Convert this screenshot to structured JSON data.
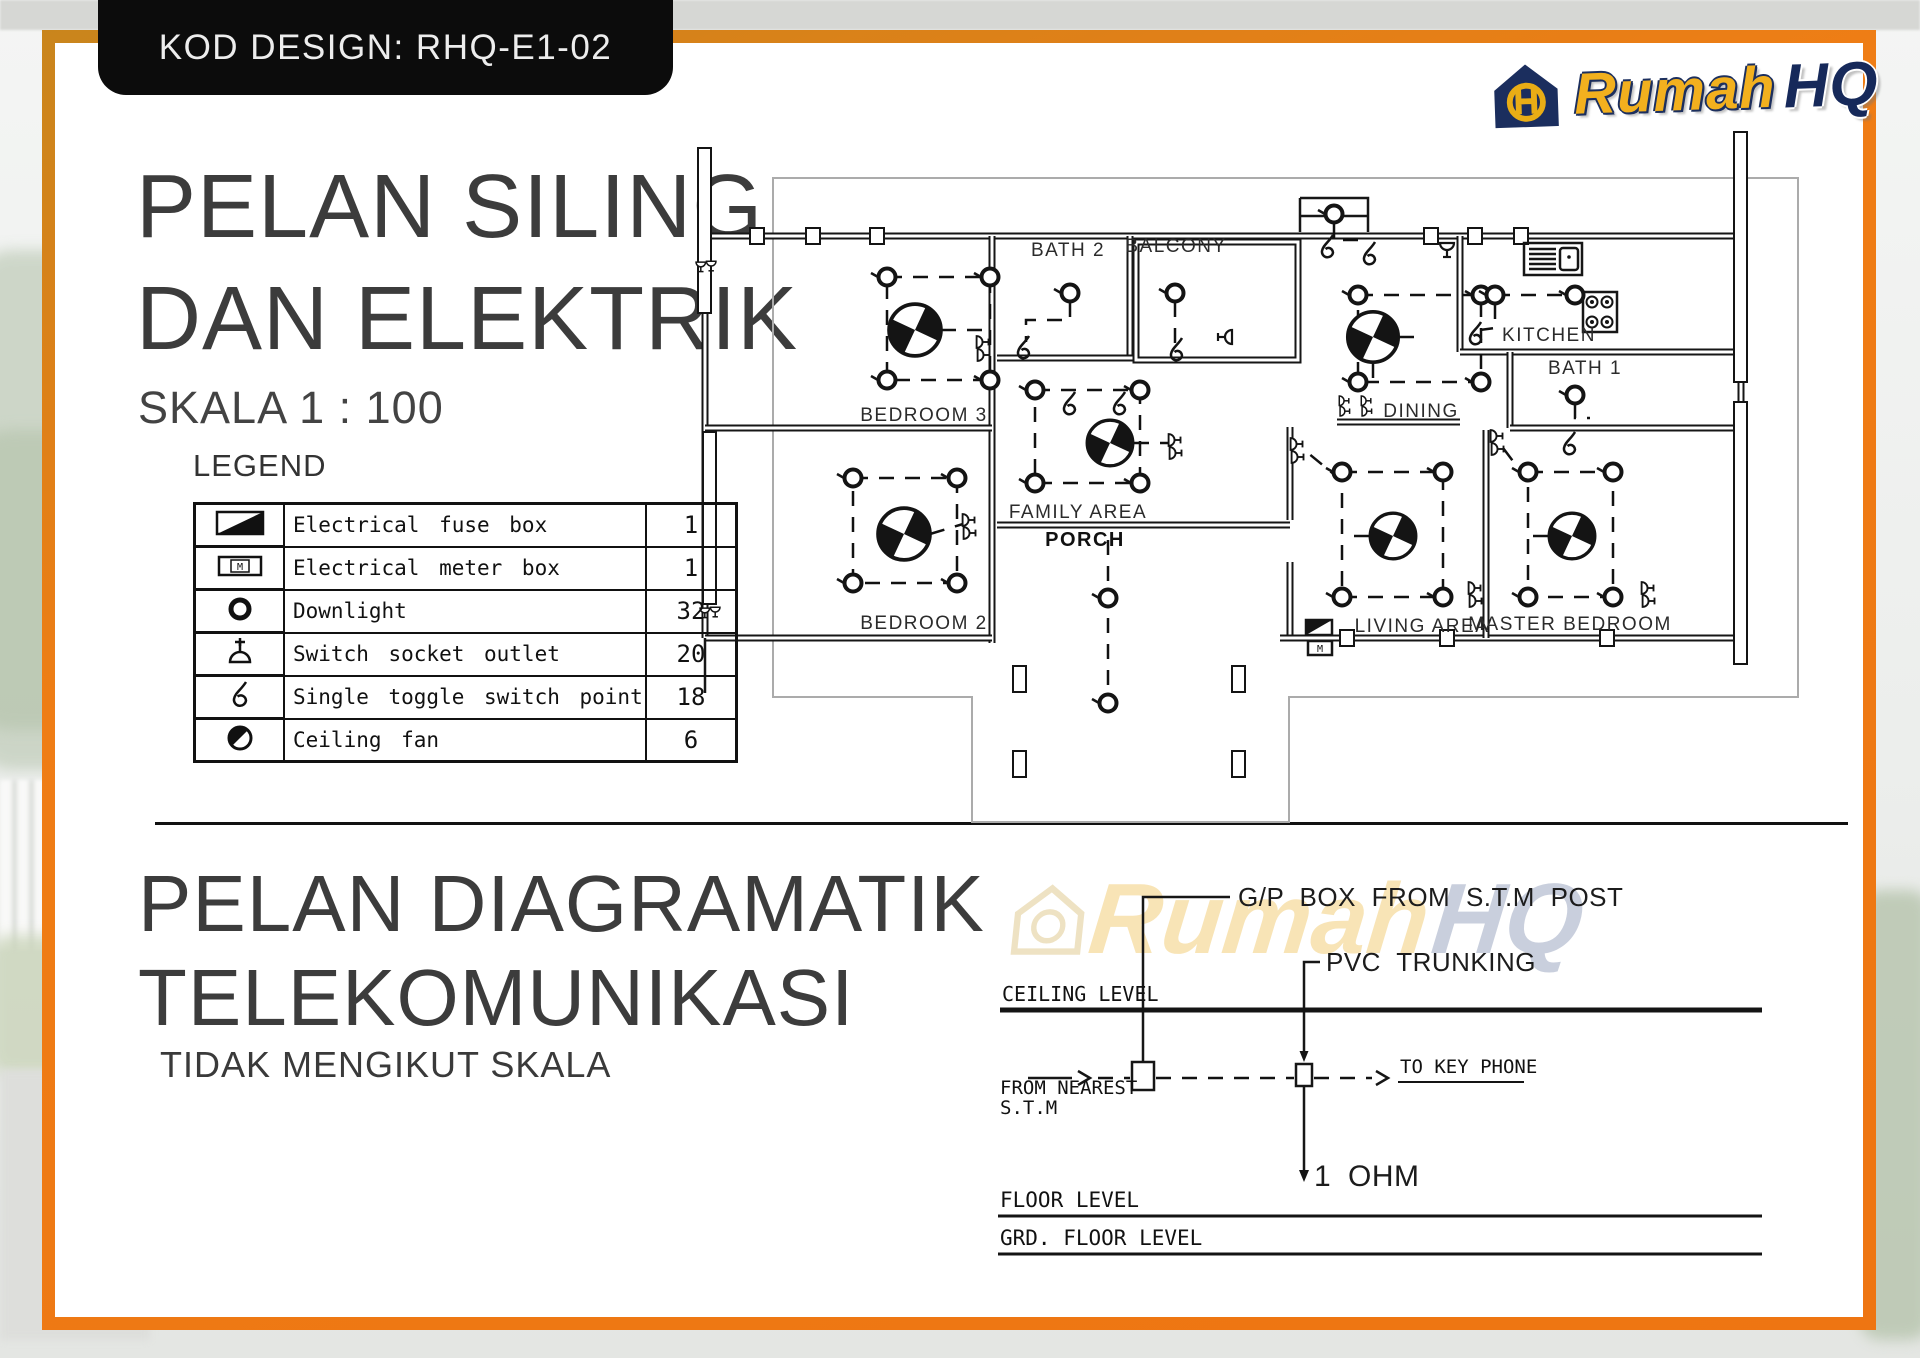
{
  "badge": {
    "label": "KOD DESIGN: RHQ-E1-02"
  },
  "logo": {
    "word_1": "Rumah",
    "word_2": "HQ",
    "icon": "house-monogram-icon",
    "colors": {
      "brand_yellow": "#f2b01e",
      "brand_navy": "#16295a",
      "frame_orange": "#ee7512"
    }
  },
  "section_top": {
    "title_line1": "PELAN SILING",
    "title_line2": "DAN ELEKTRIK",
    "scale": "SKALA 1 : 100",
    "legend": {
      "heading": "LEGEND",
      "rows": [
        {
          "symbol": "fuse-box-symbol",
          "label": "Electrical fuse box",
          "count": "1"
        },
        {
          "symbol": "meter-box-symbol",
          "label": "Electrical meter box",
          "count": "1"
        },
        {
          "symbol": "downlight-symbol",
          "label": "Downlight",
          "count": "32"
        },
        {
          "symbol": "socket-outlet-symbol",
          "label": "Switch socket outlet",
          "count": "20"
        },
        {
          "symbol": "toggle-switch-symbol",
          "label": "Single toggle switch point",
          "count": "18"
        },
        {
          "symbol": "ceiling-fan-symbol",
          "label": "Ceiling fan",
          "count": "6"
        }
      ]
    }
  },
  "floor_plan": {
    "meter_label": "M",
    "rooms": [
      "BATH 2",
      "BALCONY",
      "KITCHEN",
      "BATH 1",
      "BEDROOM 3",
      "DINING",
      "FAMILY AREA",
      "PORCH",
      "BEDROOM 2",
      "LIVING AREA",
      "MASTER BEDROOM"
    ]
  },
  "section_bottom": {
    "title_line1": "PELAN DIAGRAMATIK",
    "title_line2": "TELEKOMUNIKASI",
    "subtitle": "TIDAK MENGIKUT SKALA",
    "diagram": {
      "gp_box": "G/P BOX FROM S.T.M POST",
      "pvc": "PVC TRUNKING",
      "ceiling_level": "CEILING LEVEL",
      "from_nearest_1": "FROM NEAREST",
      "from_nearest_2": "S.T.M",
      "to_key_phone": "TO KEY PHONE",
      "ohm": "1 OHM",
      "floor_level": "FLOOR LEVEL",
      "grd_floor_level": "GRD. FLOOR LEVEL"
    }
  }
}
